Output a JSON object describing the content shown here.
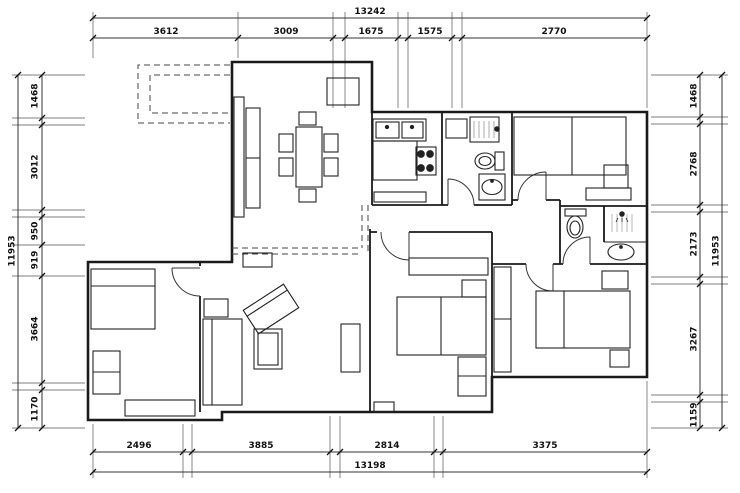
{
  "drawing": {
    "kind": "apartment floor plan",
    "colors": {
      "background": "#ffffff",
      "wall_line": "#1a1a1a",
      "dimension_line": "#333333"
    },
    "fixtures": [
      "dining-table-icon",
      "chair-icon",
      "tall-wardrobe-icon",
      "cabinet-icon",
      "kitchen-double-sink-icon",
      "stove-burners-icon",
      "counter-icon",
      "shower-icon",
      "toilet-icon",
      "wash-basin-icon",
      "double-bed-icon",
      "nightstand-icon",
      "wardrobe-icon",
      "desk-icon",
      "sofa-icon",
      "armchair-icon",
      "coffee-table-icon",
      "tv-cabinet-icon",
      "door-swing-icon",
      "balcony-dashed-outline"
    ]
  },
  "dims": {
    "top": {
      "total": "13242",
      "segments": [
        "3612",
        "3009",
        "1675",
        "1575",
        "2770"
      ]
    },
    "bottom": {
      "total": "13198",
      "segments": [
        "2496",
        "3885",
        "2814",
        "3375"
      ]
    },
    "left": {
      "total": "11953",
      "segments": [
        "1468",
        "3012",
        "950",
        "919",
        "3664",
        "1170"
      ]
    },
    "right": {
      "total": "11953",
      "segments": [
        "1468",
        "2768",
        "2173",
        "3267",
        "1159"
      ]
    }
  }
}
